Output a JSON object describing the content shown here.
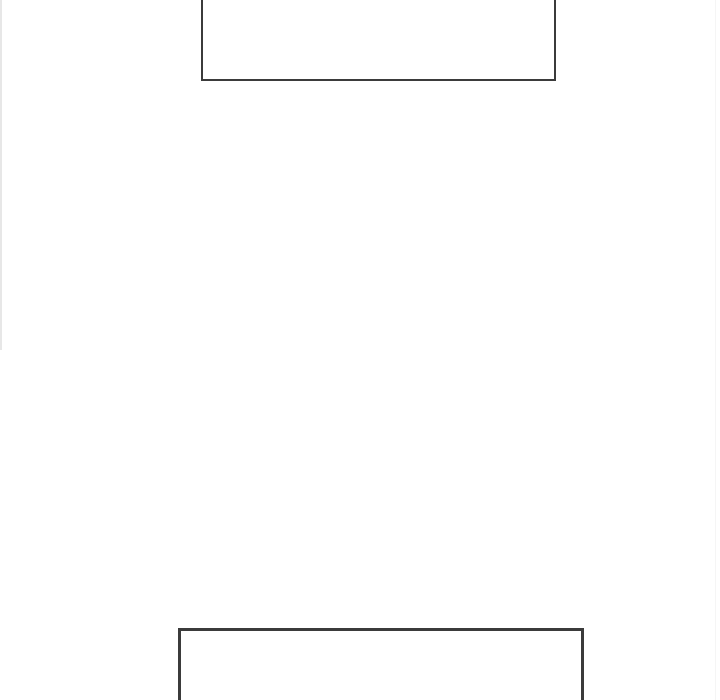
{
  "canvas": {
    "background_color": "#ffffff",
    "stroke_color": "#3b3b3b",
    "description": "blank-diagram-canvas-with-two-empty-rectangles"
  },
  "diagram": {
    "shapes": [
      {
        "id": "rectangle-top",
        "type": "rect",
        "label": "",
        "x": 201,
        "y": -12,
        "width": 355,
        "height": 93,
        "stroke": "#3b3b3b",
        "stroke_width": 2,
        "fill": "#ffffff",
        "clipped": "top-edge-of-viewport"
      },
      {
        "id": "rectangle-bottom",
        "type": "rect",
        "label": "",
        "x": 178,
        "y": 628,
        "width": 406,
        "height": 84,
        "stroke": "#3b3b3b",
        "stroke_width": 3,
        "fill": "#ffffff",
        "clipped": "bottom-edge-of-viewport"
      }
    ],
    "panel_edges": [
      {
        "id": "left-panel-edge",
        "x": 0,
        "y": 0,
        "width": 2,
        "height": 350,
        "color": "#e7e7e7"
      },
      {
        "id": "right-panel-edge",
        "x": 715,
        "y": 0,
        "width": 1,
        "height": 700,
        "color": "#f5f5f5"
      }
    ]
  }
}
